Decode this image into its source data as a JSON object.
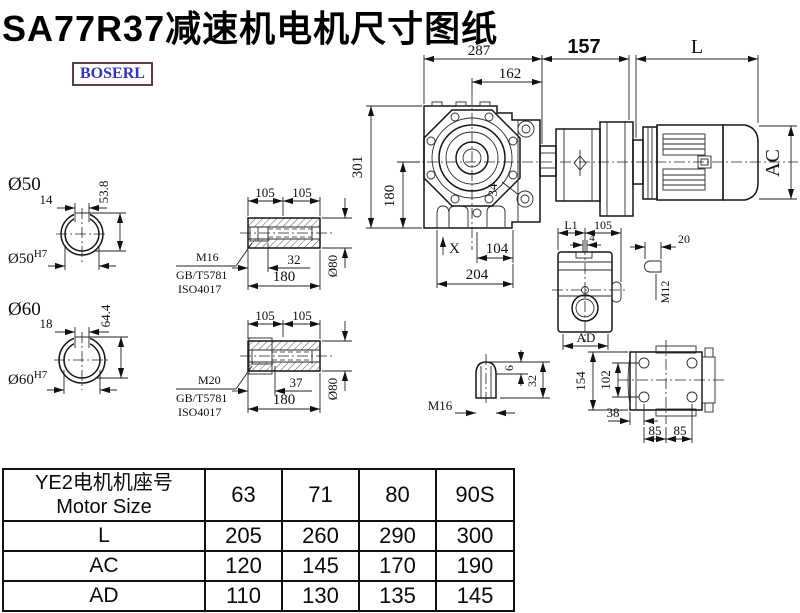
{
  "title": "SA77R37减速机电机尺寸图纸",
  "logo": {
    "text": "BOSERL"
  },
  "colors": {
    "line": "#161616",
    "logo_text": "#3333bb",
    "logo_border": "#5a4040",
    "table_border": "#111111"
  },
  "drawing": {
    "main": {
      "width_total": "287",
      "width_inner": "162",
      "adapter_len": "157",
      "motor_len": "L",
      "height_total": "301",
      "height_lower": "180",
      "motor_diameter": "AC",
      "hole_dia": "34",
      "anchor_mark": "X",
      "foot_inner": "104",
      "foot_total": "204"
    },
    "shaft50": {
      "title": "Ø50",
      "key_width": "14",
      "key_depth": "53.8",
      "bore": "Ø50",
      "bore_tol": "H7"
    },
    "shaft60": {
      "title": "Ø60",
      "key_width": "18",
      "key_depth": "64.4",
      "bore": "Ø60",
      "bore_tol": "H7"
    },
    "hollow_shaft_a": {
      "len_a": "105",
      "len_b": "105",
      "thread": "M16",
      "std_gb": "GB/T5781",
      "std_iso": "ISO4017",
      "key_len": "32",
      "total_len": "180",
      "dia": "Ø80"
    },
    "hollow_shaft_b": {
      "len_a": "105",
      "len_b": "105",
      "thread": "M20",
      "std_gb": "GB/T5781",
      "std_iso": "ISO4017",
      "key_len": "37",
      "total_len": "180",
      "dia": "Ø80"
    },
    "plug": {
      "thread": "M16",
      "tip": "6",
      "len": "32"
    },
    "side_view": {
      "dim_l1": "L1",
      "dim_105": "105",
      "dim_4": "4",
      "dim_ad": "AD"
    },
    "key_detail": {
      "width": "20",
      "thread": "M12"
    },
    "rear_view": {
      "height": "154",
      "bolt_span_v": "102",
      "offset": "38",
      "bolt_a": "85",
      "bolt_b": "85"
    }
  },
  "table": {
    "header": {
      "line1": "YE2电机机座号",
      "line2": "Motor Size",
      "cols": [
        "63",
        "71",
        "80",
        "90S"
      ]
    },
    "rows": [
      {
        "label": "L",
        "values": [
          "205",
          "260",
          "290",
          "300"
        ]
      },
      {
        "label": "AC",
        "values": [
          "120",
          "145",
          "170",
          "190"
        ]
      },
      {
        "label": "AD",
        "values": [
          "110",
          "130",
          "135",
          "145"
        ]
      }
    ]
  }
}
